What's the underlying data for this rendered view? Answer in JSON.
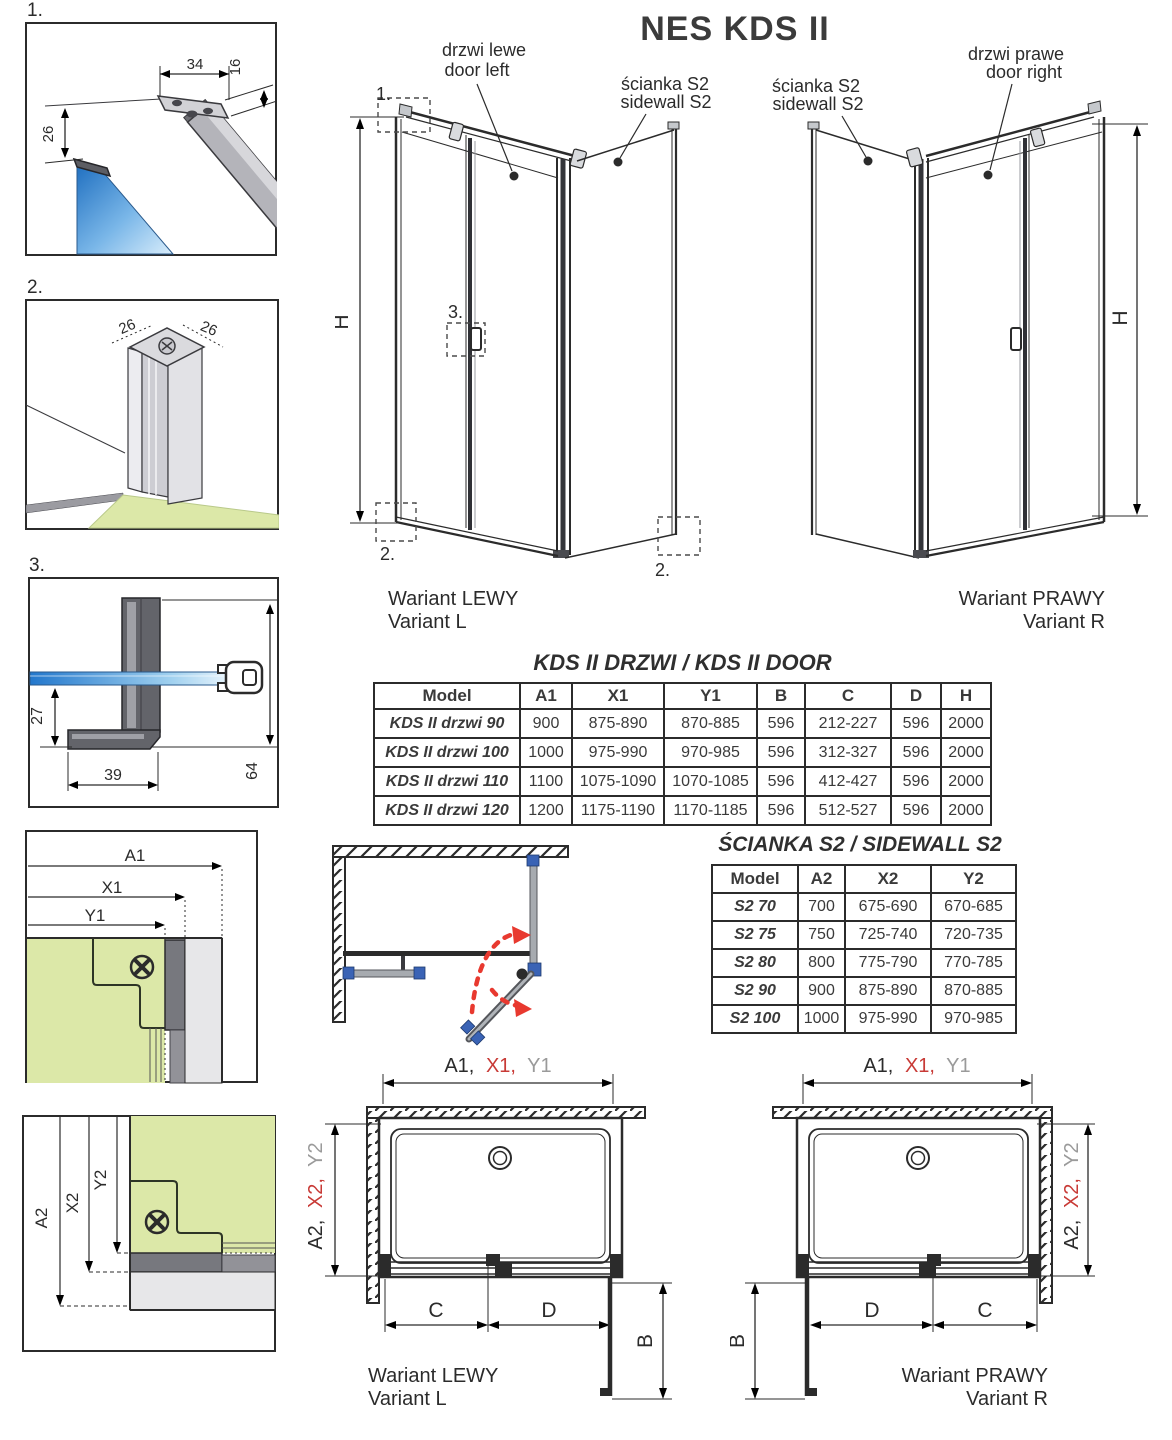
{
  "title": "NES KDS II",
  "colors": {
    "ink": "#2b2b2b",
    "dim_red": "#c83a36",
    "dim_gray": "#9a9a9a",
    "dim_blue": "#2d5fa8",
    "dim_green": "#58b14c",
    "dim_purple": "#5a4b9e",
    "glass_blue": "#2277cc",
    "floor_green": "#dce8a8",
    "clamp_blue": "#3a63b5",
    "swing_arrow_red": "#e8392f"
  },
  "details": {
    "d1": {
      "label": "1.",
      "dim_width": "34",
      "dim_thickness": "16",
      "dim_offset": "26"
    },
    "d2": {
      "label": "2.",
      "dim_left": "26",
      "dim_right": "26"
    },
    "d3": {
      "label": "3.",
      "dim_drop": "27",
      "dim_foot": "39",
      "dim_height": "64"
    }
  },
  "variant_left": {
    "door_label_pl": "drzwi lewe",
    "door_label_en": "door left",
    "sidewall_label_pl": "ścianka S2",
    "sidewall_label_en": "sidewall S2",
    "height_label": "H",
    "callout_1": "1.",
    "callout_2a": "2.",
    "callout_2b": "2.",
    "callout_3": "3.",
    "caption_pl": "Wariant LEWY",
    "caption_en": "Variant L"
  },
  "variant_right": {
    "door_label_pl": "drzwi prawe",
    "door_label_en": "door right",
    "sidewall_label_pl": "ścianka S2",
    "sidewall_label_en": "sidewall S2",
    "height_label": "H",
    "caption_pl": "Wariant PRAWY",
    "caption_en": "Variant R"
  },
  "door_table": {
    "title": "KDS II DRZWI / KDS II DOOR",
    "headers": [
      "Model",
      "A1",
      "X1",
      "Y1",
      "B",
      "C",
      "D",
      "H"
    ],
    "rows": [
      [
        "KDS II drzwi 90",
        "900",
        "875-890",
        "870-885",
        "596",
        "212-227",
        "596",
        "2000"
      ],
      [
        "KDS II drzwi 100",
        "1000",
        "975-990",
        "970-985",
        "596",
        "312-327",
        "596",
        "2000"
      ],
      [
        "KDS II drzwi 110",
        "1100",
        "1075-1090",
        "1070-1085",
        "596",
        "412-427",
        "596",
        "2000"
      ],
      [
        "KDS II drzwi 120",
        "1200",
        "1175-1190",
        "1170-1185",
        "596",
        "512-527",
        "596",
        "2000"
      ]
    ]
  },
  "sidewall_table": {
    "title": "ŚCIANKA S2 / SIDEWALL S2",
    "headers": [
      "Model",
      "A2",
      "X2",
      "Y2"
    ],
    "rows": [
      [
        "S2 70",
        "700",
        "675-690",
        "670-685"
      ],
      [
        "S2 75",
        "750",
        "725-740",
        "720-735"
      ],
      [
        "S2 80",
        "800",
        "775-790",
        "770-785"
      ],
      [
        "S2 90",
        "900",
        "875-890",
        "870-885"
      ],
      [
        "S2 100",
        "1000",
        "975-990",
        "970-985"
      ]
    ]
  },
  "corner_detail_h": {
    "a": "A1",
    "x": "X1",
    "y": "Y1"
  },
  "corner_detail_v": {
    "a": "A2",
    "x": "X2",
    "y": "Y2"
  },
  "plan_left": {
    "top_a": "A1,",
    "top_x": "X1,",
    "top_y": "Y1",
    "side_a": "A2,",
    "side_x": "X2,",
    "side_y": "Y2",
    "dim_c": "C",
    "dim_d": "D",
    "dim_b": "B",
    "caption_pl": "Wariant LEWY",
    "caption_en": "Variant L"
  },
  "plan_right": {
    "top_a": "A1,",
    "top_x": "X1,",
    "top_y": "Y1",
    "side_a": "A2,",
    "side_x": "X2,",
    "side_y": "Y2",
    "dim_c": "C",
    "dim_d": "D",
    "dim_b": "B",
    "caption_pl": "Wariant PRAWY",
    "caption_en": "Variant R"
  }
}
